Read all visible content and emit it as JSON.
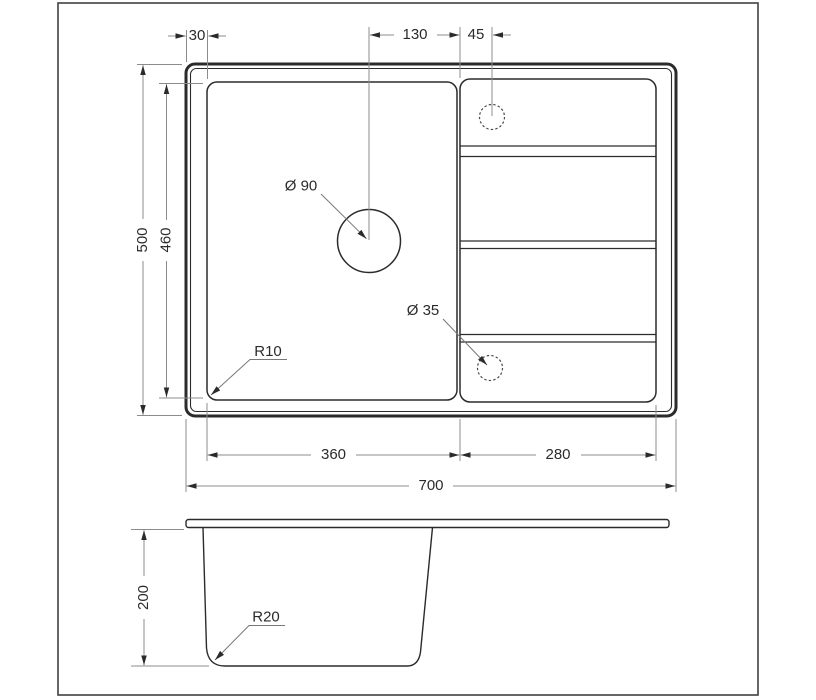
{
  "drawing_type": "sink-dimension-drawing",
  "colors": {
    "object_line": "#2b2b2b",
    "dimension_line": "#8c8c8c",
    "text": "#2b2b2b",
    "background": "#ffffff",
    "frame": "#404040"
  },
  "top_view": {
    "dim_rim_offset": "30",
    "dim_drain_to_divider": "130",
    "dim_divider_to_tap": "45",
    "dim_overall_depth": "500",
    "dim_bowl_inner_depth": "460",
    "dim_bowl_width": "360",
    "dim_drainboard_width": "280",
    "dim_overall_width": "700",
    "label_drain_hole": "Ø 90",
    "label_tap_hole": "Ø 35",
    "label_corner_radius": "R10"
  },
  "side_view": {
    "dim_bowl_height": "200",
    "label_bottom_radius": "R20"
  }
}
